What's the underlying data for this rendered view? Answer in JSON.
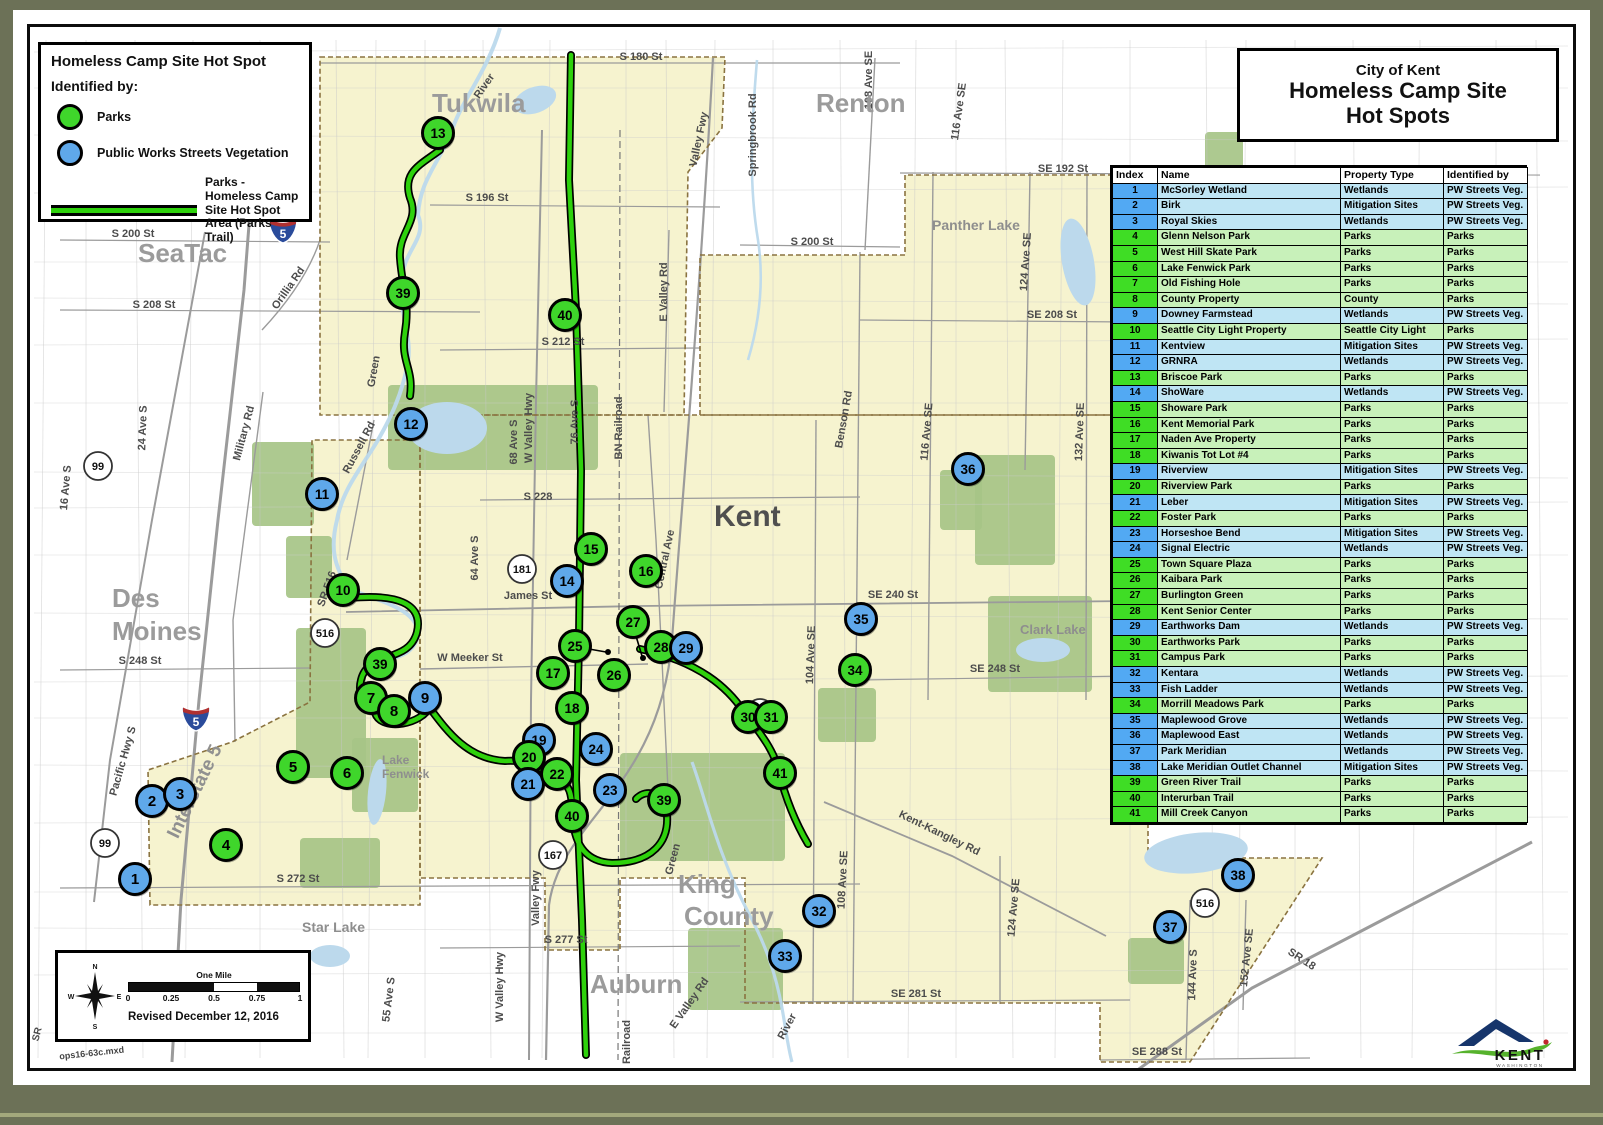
{
  "title_box": {
    "line1": "City of Kent",
    "line2": "Homeless Camp Site",
    "line3": "Hot Spots"
  },
  "legend": {
    "title": "Homeless Camp Site Hot Spot",
    "subtitle": "Identified by:",
    "items": [
      {
        "label": "Parks",
        "swatch": "circle",
        "color": "#3fd62b"
      },
      {
        "label": "Public Works Streets Vegetation",
        "swatch": "circle",
        "color": "#5fa8ea"
      },
      {
        "label": "Parks - Homeless Camp Site Hot Spot Area (Parks Trail)",
        "swatch": "line",
        "color": "#2ed10c"
      }
    ]
  },
  "scale_box": {
    "scale_title": "One Mile",
    "ticks": [
      "0",
      "0.25",
      "0.5",
      "0.75",
      "1"
    ],
    "compass": [
      "N",
      "E",
      "S",
      "W"
    ],
    "revised": "Revised December 12, 2016"
  },
  "logo": {
    "name": "KENT",
    "subtext": "WASHINGTON"
  },
  "table": {
    "headers": [
      "Index",
      "Name",
      "Property Type",
      "Identified by"
    ],
    "rows": [
      [
        "1",
        "McSorley Wetland",
        "Wetlands",
        "PW Streets Veg."
      ],
      [
        "2",
        "Birk",
        "Mitigation Sites",
        "PW Streets Veg."
      ],
      [
        "3",
        "Royal Skies",
        "Wetlands",
        "PW Streets Veg."
      ],
      [
        "4",
        "Glenn Nelson Park",
        "Parks",
        "Parks"
      ],
      [
        "5",
        "West Hill Skate Park",
        "Parks",
        "Parks"
      ],
      [
        "6",
        "Lake Fenwick Park",
        "Parks",
        "Parks"
      ],
      [
        "7",
        "Old Fishing Hole",
        "Parks",
        "Parks"
      ],
      [
        "8",
        "County Property",
        "County",
        "Parks"
      ],
      [
        "9",
        "Downey Farmstead",
        "Wetlands",
        "PW Streets Veg."
      ],
      [
        "10",
        "Seattle City Light Property",
        "Seattle City Light",
        "Parks"
      ],
      [
        "11",
        "Kentview",
        "Mitigation Sites",
        "PW Streets Veg."
      ],
      [
        "12",
        "GRNRA",
        "Wetlands",
        "PW Streets Veg."
      ],
      [
        "13",
        "Briscoe Park",
        "Parks",
        "Parks"
      ],
      [
        "14",
        "ShoWare",
        "Wetlands",
        "PW Streets Veg."
      ],
      [
        "15",
        "Showare Park",
        "Parks",
        "Parks"
      ],
      [
        "16",
        "Kent Memorial Park",
        "Parks",
        "Parks"
      ],
      [
        "17",
        "Naden Ave Property",
        "Parks",
        "Parks"
      ],
      [
        "18",
        "Kiwanis Tot Lot #4",
        "Parks",
        "Parks"
      ],
      [
        "19",
        "Riverview",
        "Mitigation Sites",
        "PW Streets Veg."
      ],
      [
        "20",
        "Riverview Park",
        "Parks",
        "Parks"
      ],
      [
        "21",
        "Leber",
        "Mitigation Sites",
        "PW Streets Veg."
      ],
      [
        "22",
        "Foster Park",
        "Parks",
        "Parks"
      ],
      [
        "23",
        "Horseshoe Bend",
        "Mitigation Sites",
        "PW Streets Veg."
      ],
      [
        "24",
        "Signal Electric",
        "Wetlands",
        "PW Streets Veg."
      ],
      [
        "25",
        "Town Square Plaza",
        "Parks",
        "Parks"
      ],
      [
        "26",
        "Kaibara Park",
        "Parks",
        "Parks"
      ],
      [
        "27",
        "Burlington Green",
        "Parks",
        "Parks"
      ],
      [
        "28",
        "Kent Senior Center",
        "Parks",
        "Parks"
      ],
      [
        "29",
        "Earthworks Dam",
        "Wetlands",
        "PW Streets Veg."
      ],
      [
        "30",
        "Earthworks Park",
        "Parks",
        "Parks"
      ],
      [
        "31",
        "Campus Park",
        "Parks",
        "Parks"
      ],
      [
        "32",
        "Kentara",
        "Wetlands",
        "PW Streets Veg."
      ],
      [
        "33",
        "Fish Ladder",
        "Wetlands",
        "PW Streets Veg."
      ],
      [
        "34",
        "Morrill Meadows Park",
        "Parks",
        "Parks"
      ],
      [
        "35",
        "Maplewood Grove",
        "Wetlands",
        "PW Streets Veg."
      ],
      [
        "36",
        "Maplewood East",
        "Wetlands",
        "PW Streets Veg."
      ],
      [
        "37",
        "Park Meridian",
        "Wetlands",
        "PW Streets Veg."
      ],
      [
        "38",
        "Lake Meridian Outlet Channel",
        "Mitigation Sites",
        "PW Streets Veg."
      ],
      [
        "39",
        "Green River Trail",
        "Parks",
        "Parks"
      ],
      [
        "40",
        "Interurban Trail",
        "Parks",
        "Parks"
      ],
      [
        "41",
        "Mill Creek Canyon",
        "Parks",
        "Parks"
      ]
    ]
  },
  "colors": {
    "parks_marker": "#3fd62b",
    "pw_marker": "#5fa8ea",
    "trail_green": "#2ed10c",
    "city_fill": "#f6f3cf",
    "park_fill": "#a6c487",
    "water_fill": "#bcd9ec"
  },
  "map": {
    "markers": [
      {
        "n": "1",
        "x": 135,
        "y": 879,
        "t": "b"
      },
      {
        "n": "2",
        "x": 152,
        "y": 801,
        "t": "b"
      },
      {
        "n": "3",
        "x": 180,
        "y": 794,
        "t": "b"
      },
      {
        "n": "4",
        "x": 226,
        "y": 845,
        "t": "g"
      },
      {
        "n": "5",
        "x": 293,
        "y": 767,
        "t": "g"
      },
      {
        "n": "6",
        "x": 347,
        "y": 773,
        "t": "g"
      },
      {
        "n": "7",
        "x": 371,
        "y": 698,
        "t": "g"
      },
      {
        "n": "8",
        "x": 394,
        "y": 711,
        "t": "g"
      },
      {
        "n": "9",
        "x": 425,
        "y": 698,
        "t": "b"
      },
      {
        "n": "10",
        "x": 343,
        "y": 590,
        "t": "g"
      },
      {
        "n": "11",
        "x": 322,
        "y": 494,
        "t": "b"
      },
      {
        "n": "12",
        "x": 411,
        "y": 424,
        "t": "b"
      },
      {
        "n": "13",
        "x": 438,
        "y": 133,
        "t": "g"
      },
      {
        "n": "14",
        "x": 567,
        "y": 581,
        "t": "b"
      },
      {
        "n": "15",
        "x": 591,
        "y": 549,
        "t": "g"
      },
      {
        "n": "16",
        "x": 646,
        "y": 571,
        "t": "g"
      },
      {
        "n": "17",
        "x": 553,
        "y": 673,
        "t": "g"
      },
      {
        "n": "18",
        "x": 572,
        "y": 708,
        "t": "g"
      },
      {
        "n": "19",
        "x": 539,
        "y": 740,
        "t": "b"
      },
      {
        "n": "20",
        "x": 529,
        "y": 757,
        "t": "g"
      },
      {
        "n": "21",
        "x": 528,
        "y": 784,
        "t": "b"
      },
      {
        "n": "22",
        "x": 557,
        "y": 774,
        "t": "g"
      },
      {
        "n": "23",
        "x": 610,
        "y": 790,
        "t": "b"
      },
      {
        "n": "24",
        "x": 596,
        "y": 749,
        "t": "b"
      },
      {
        "n": "25",
        "x": 575,
        "y": 646,
        "t": "g"
      },
      {
        "n": "26",
        "x": 614,
        "y": 675,
        "t": "g"
      },
      {
        "n": "27",
        "x": 633,
        "y": 622,
        "t": "g"
      },
      {
        "n": "28",
        "x": 661,
        "y": 647,
        "t": "g"
      },
      {
        "n": "29",
        "x": 686,
        "y": 648,
        "t": "b"
      },
      {
        "n": "30",
        "x": 748,
        "y": 717,
        "t": "g"
      },
      {
        "n": "31",
        "x": 771,
        "y": 717,
        "t": "g"
      },
      {
        "n": "32",
        "x": 819,
        "y": 911,
        "t": "b"
      },
      {
        "n": "33",
        "x": 785,
        "y": 956,
        "t": "b"
      },
      {
        "n": "34",
        "x": 855,
        "y": 670,
        "t": "g"
      },
      {
        "n": "35",
        "x": 861,
        "y": 619,
        "t": "b"
      },
      {
        "n": "36",
        "x": 968,
        "y": 469,
        "t": "b"
      },
      {
        "n": "37",
        "x": 1170,
        "y": 927,
        "t": "b"
      },
      {
        "n": "38",
        "x": 1238,
        "y": 875,
        "t": "b"
      },
      {
        "n": "39",
        "x": 403,
        "y": 293,
        "t": "g"
      },
      {
        "n": "39",
        "x": 380,
        "y": 664,
        "t": "g"
      },
      {
        "n": "39",
        "x": 664,
        "y": 800,
        "t": "g"
      },
      {
        "n": "40",
        "x": 565,
        "y": 315,
        "t": "g"
      },
      {
        "n": "40",
        "x": 572,
        "y": 816,
        "t": "g"
      },
      {
        "n": "41",
        "x": 780,
        "y": 773,
        "t": "g"
      }
    ],
    "shields": [
      {
        "t": "5",
        "x": 283,
        "y": 228,
        "k": "i"
      },
      {
        "t": "5",
        "x": 196,
        "y": 716,
        "k": "i"
      },
      {
        "t": "99",
        "x": 98,
        "y": 466,
        "k": "c"
      },
      {
        "t": "99",
        "x": 105,
        "y": 843,
        "k": "c"
      },
      {
        "t": "181",
        "x": 522,
        "y": 569,
        "k": "c"
      },
      {
        "t": "516",
        "x": 325,
        "y": 633,
        "k": "c"
      },
      {
        "t": "516",
        "x": 760,
        "y": 713,
        "k": "c"
      },
      {
        "t": "516",
        "x": 1205,
        "y": 903,
        "k": "c"
      },
      {
        "t": "167",
        "x": 553,
        "y": 855,
        "k": "c"
      }
    ],
    "city_labels": [
      {
        "t": "Tukwila",
        "x": 432,
        "y": 112,
        "s": 26
      },
      {
        "t": "Renton",
        "x": 816,
        "y": 112,
        "s": 26
      },
      {
        "t": "SeaTac",
        "x": 138,
        "y": 262,
        "s": 26
      },
      {
        "t": "Des",
        "x": 112,
        "y": 607,
        "s": 26
      },
      {
        "t": "Moines",
        "x": 112,
        "y": 640,
        "s": 26
      },
      {
        "t": "Kent",
        "x": 714,
        "y": 526,
        "s": 30,
        "c": "#4f4f4f"
      },
      {
        "t": "King",
        "x": 678,
        "y": 893,
        "s": 26
      },
      {
        "t": "County",
        "x": 684,
        "y": 925,
        "s": 26
      },
      {
        "t": "Auburn",
        "x": 590,
        "y": 993,
        "s": 26
      },
      {
        "t": "Star Lake",
        "x": 302,
        "y": 932,
        "s": 14,
        "c": "#8e8e8e"
      },
      {
        "t": "Panther Lake",
        "x": 932,
        "y": 230,
        "s": 14,
        "c": "#8e8e8e"
      },
      {
        "t": "Clark Lake",
        "x": 1020,
        "y": 634,
        "s": 13,
        "c": "#8e8e8e"
      },
      {
        "t": "Lake",
        "x": 382,
        "y": 764,
        "s": 12,
        "c": "#8e8e8e"
      },
      {
        "t": "Fenwick",
        "x": 382,
        "y": 778,
        "s": 12,
        "c": "#8e8e8e"
      }
    ],
    "street_labels": [
      {
        "t": "S 180 St",
        "x": 641,
        "y": 60
      },
      {
        "t": "S 196 St",
        "x": 487,
        "y": 201
      },
      {
        "t": "S 200 St",
        "x": 133,
        "y": 237
      },
      {
        "t": "S 208 St",
        "x": 154,
        "y": 308
      },
      {
        "t": "SE 192 St",
        "x": 1063,
        "y": 172
      },
      {
        "t": "S 200 St",
        "x": 812,
        "y": 245
      },
      {
        "t": "SE 208 St",
        "x": 1052,
        "y": 318
      },
      {
        "t": "Springbrook Rd",
        "x": 756,
        "y": 135,
        "r": -90
      },
      {
        "t": "Valley Fwy",
        "x": 702,
        "y": 140,
        "r": -78
      },
      {
        "t": "108 Ave SE",
        "x": 872,
        "y": 80,
        "r": -90
      },
      {
        "t": "116 Ave SE",
        "x": 962,
        "y": 112,
        "r": -82
      },
      {
        "t": "124 Ave SE",
        "x": 1029,
        "y": 262,
        "r": -86
      },
      {
        "t": "E Valley Rd",
        "x": 667,
        "y": 292,
        "r": -90
      },
      {
        "t": "W Valley Hwy",
        "x": 532,
        "y": 428,
        "r": -90
      },
      {
        "t": "BN Railroad",
        "x": 622,
        "y": 428,
        "r": -90
      },
      {
        "t": "76 Ave S",
        "x": 578,
        "y": 422,
        "r": -90
      },
      {
        "t": "68 Ave S",
        "x": 517,
        "y": 442,
        "r": -90
      },
      {
        "t": "64 Ave S",
        "x": 478,
        "y": 558,
        "r": -90
      },
      {
        "t": "Military Rd",
        "x": 247,
        "y": 434,
        "r": -75
      },
      {
        "t": "Orillia Rd",
        "x": 291,
        "y": 290,
        "r": -55
      },
      {
        "t": "Russell Rd",
        "x": 362,
        "y": 449,
        "r": -62
      },
      {
        "t": "Green",
        "x": 377,
        "y": 372,
        "r": -80
      },
      {
        "t": "River",
        "x": 487,
        "y": 88,
        "r": -55
      },
      {
        "t": "24 Ave S",
        "x": 146,
        "y": 428,
        "r": -88
      },
      {
        "t": "16 Ave S",
        "x": 69,
        "y": 488,
        "r": -85
      },
      {
        "t": "S 228",
        "x": 538,
        "y": 500
      },
      {
        "t": "James St",
        "x": 528,
        "y": 599
      },
      {
        "t": "W Meeker St",
        "x": 470,
        "y": 661
      },
      {
        "t": "Central Ave",
        "x": 668,
        "y": 560,
        "r": -78
      },
      {
        "t": "SE 240 St",
        "x": 893,
        "y": 598
      },
      {
        "t": "S 248 St",
        "x": 140,
        "y": 664
      },
      {
        "t": "SE 248 St",
        "x": 995,
        "y": 672
      },
      {
        "t": "S 272 St",
        "x": 298,
        "y": 882
      },
      {
        "t": "S 212 St",
        "x": 563,
        "y": 345
      },
      {
        "t": "S 277 St",
        "x": 566,
        "y": 943
      },
      {
        "t": "SE 281 St",
        "x": 916,
        "y": 997
      },
      {
        "t": "SE 288 St",
        "x": 1157,
        "y": 1055
      },
      {
        "t": "Kent-Kangley Rd",
        "x": 938,
        "y": 836,
        "r": 26
      },
      {
        "t": "SR 18",
        "x": 1300,
        "y": 962,
        "r": 33
      },
      {
        "t": "SR 516",
        "x": 330,
        "y": 590,
        "r": -70
      },
      {
        "t": "104 Ave SE",
        "x": 814,
        "y": 655,
        "r": -88
      },
      {
        "t": "108 Ave SE",
        "x": 846,
        "y": 880,
        "r": -87
      },
      {
        "t": "116 Ave SE",
        "x": 930,
        "y": 432,
        "r": -85
      },
      {
        "t": "132 Ave SE",
        "x": 1083,
        "y": 432,
        "r": -88
      },
      {
        "t": "124 Ave SE",
        "x": 1017,
        "y": 908,
        "r": -85
      },
      {
        "t": "144 Ave S",
        "x": 1196,
        "y": 975,
        "r": -88
      },
      {
        "t": "152 Ave SE",
        "x": 1250,
        "y": 958,
        "r": -84
      },
      {
        "t": "Benson Rd",
        "x": 847,
        "y": 420,
        "r": -80
      },
      {
        "t": "Pacific Hwy S",
        "x": 126,
        "y": 762,
        "r": -74
      },
      {
        "t": "Interstate 5",
        "x": 200,
        "y": 794,
        "r": -64,
        "s": 19,
        "c": "#909090"
      },
      {
        "t": "W Valley Hwy",
        "x": 503,
        "y": 987,
        "r": -90
      },
      {
        "t": "Valley Fwy",
        "x": 539,
        "y": 898,
        "r": -90
      },
      {
        "t": "55 Ave S",
        "x": 392,
        "y": 1000,
        "r": -83
      },
      {
        "t": "E Valley Rd",
        "x": 692,
        "y": 1005,
        "r": -55
      },
      {
        "t": "Railroad",
        "x": 630,
        "y": 1042,
        "r": -90
      },
      {
        "t": "River",
        "x": 790,
        "y": 1028,
        "r": -62
      },
      {
        "t": "Green",
        "x": 676,
        "y": 860,
        "r": -75
      },
      {
        "t": "SR",
        "x": 40,
        "y": 1035,
        "r": -75,
        "s": 10
      },
      {
        "t": "ops16-63c.mxd",
        "x": 92,
        "y": 1056,
        "r": -6,
        "s": 9,
        "c": "#444444"
      }
    ]
  }
}
